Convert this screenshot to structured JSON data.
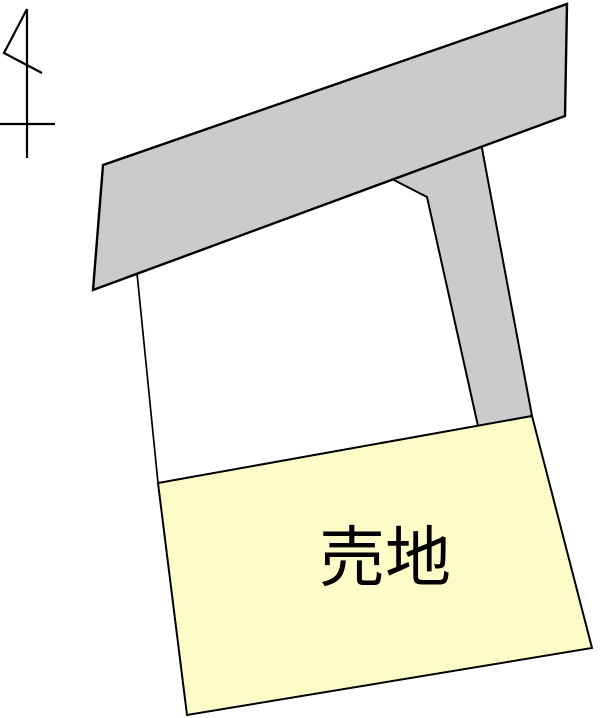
{
  "map": {
    "title": "land-plot-map",
    "parcel": {
      "label": "売地"
    },
    "colors": {
      "background": "#ffffff",
      "road_fill": "#cbcbcb",
      "parcel_fill": "#fcfcc8",
      "line": "#000000",
      "text": "#000000"
    },
    "icons": {
      "north_arrow": "north-arrow-icon"
    }
  }
}
